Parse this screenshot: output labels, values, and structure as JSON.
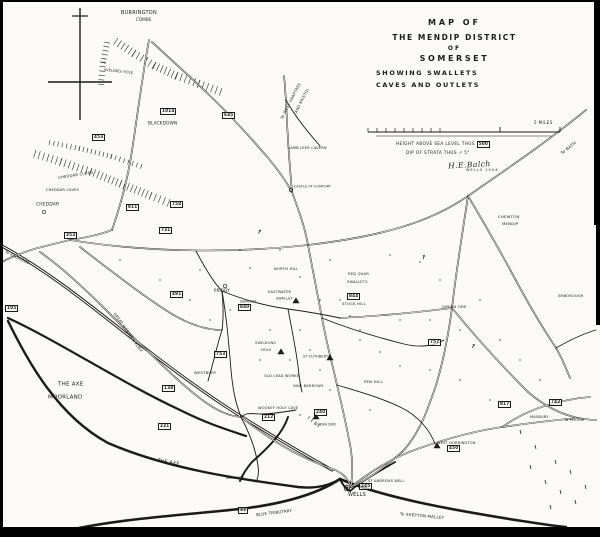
{
  "canvas": {
    "width": 600,
    "height": 537,
    "ink": "#1b1b1b",
    "paper": "#fbfaf6",
    "frame": "#000000"
  },
  "title": {
    "lines": [
      "MAP OF",
      "THE MENDIP DISTRICT",
      "OF",
      "SOMERSET",
      "SHOWING SWALLETS",
      "CAVES AND OUTLETS"
    ]
  },
  "scale_bar": {
    "right_label": "5 MILES"
  },
  "legend": {
    "height_note": "HEIGHT ABOVE SEA LEVEL THUS",
    "height_sample": "500",
    "dip_note": "DIP OF STRATA THUS",
    "dip_sample": "5°",
    "signature": "H.E.Balch",
    "place_date": "WELLS 1904"
  },
  "icons": {
    "dip_arrow": "↗",
    "north_cross": "cross"
  },
  "labels": [
    {
      "text": "BURRINGTON",
      "x": 121,
      "y": 10,
      "s": 5,
      "r": 0
    },
    {
      "text": "COMBE",
      "x": 136,
      "y": 18,
      "s": 4,
      "r": 0
    },
    {
      "text": "AVELINES HOLE",
      "x": 104,
      "y": 68,
      "s": 3.5,
      "r": 6
    },
    {
      "text": "BLACKDOWN",
      "x": 148,
      "y": 121,
      "s": 4.2,
      "r": 0
    },
    {
      "text": "CHEDDAR CLIFFS",
      "x": 58,
      "y": 176,
      "s": 3.8,
      "r": -9
    },
    {
      "text": "CHEDDAR CAVES",
      "x": 46,
      "y": 188,
      "s": 3.6,
      "r": 0
    },
    {
      "text": "CHEDDAR",
      "x": 36,
      "y": 202,
      "s": 4.4,
      "r": 0
    },
    {
      "text": "To AXBRIDGE",
      "x": 6,
      "y": 250,
      "s": 3.8,
      "r": 26
    },
    {
      "text": "GREAT WESTERN RLWY",
      "x": 116,
      "y": 312,
      "s": 3.8,
      "r": 55
    },
    {
      "text": "THE AXE",
      "x": 58,
      "y": 381,
      "s": 5.5,
      "r": 0
    },
    {
      "text": "MOORLAND",
      "x": 48,
      "y": 394,
      "s": 5.5,
      "r": 0
    },
    {
      "text": "THE AXE",
      "x": 158,
      "y": 458,
      "s": 4.8,
      "r": 9
    },
    {
      "text": "WESTBURY",
      "x": 194,
      "y": 371,
      "s": 3.8,
      "r": 0
    },
    {
      "text": "PRIDDY",
      "x": 214,
      "y": 289,
      "s": 4,
      "r": 0
    },
    {
      "text": "SWALLET",
      "x": 240,
      "y": 300,
      "s": 3.4,
      "r": 0
    },
    {
      "text": "EASTWATER",
      "x": 268,
      "y": 290,
      "s": 3.6,
      "r": 0
    },
    {
      "text": "SWALLET",
      "x": 276,
      "y": 297,
      "s": 3.4,
      "r": 0
    },
    {
      "text": "NORTH HILL",
      "x": 274,
      "y": 267,
      "s": 3.8,
      "r": 0
    },
    {
      "text": "RED QUAR",
      "x": 348,
      "y": 272,
      "s": 3.7,
      "r": 0
    },
    {
      "text": "SWALLETS",
      "x": 347,
      "y": 280,
      "s": 3.7,
      "r": 0
    },
    {
      "text": "STOCK HILL",
      "x": 342,
      "y": 302,
      "s": 3.8,
      "r": 0
    },
    {
      "text": "SWILDONS",
      "x": 255,
      "y": 341,
      "s": 3.6,
      "r": 0
    },
    {
      "text": "HOLE",
      "x": 261,
      "y": 348,
      "s": 3.6,
      "r": 0
    },
    {
      "text": "ST CUTHBERTS",
      "x": 303,
      "y": 355,
      "s": 3.4,
      "r": 0
    },
    {
      "text": "OLD LEAD WORKS",
      "x": 264,
      "y": 374,
      "s": 3.6,
      "r": 0
    },
    {
      "text": "NINE BARROWS",
      "x": 293,
      "y": 384,
      "s": 3.6,
      "r": 0
    },
    {
      "text": "PEN HILL",
      "x": 364,
      "y": 380,
      "s": 3.9,
      "r": 0
    },
    {
      "text": "WOOKEY HOLE CAVE",
      "x": 258,
      "y": 406,
      "s": 3.6,
      "r": 0
    },
    {
      "text": "HYENA DEN",
      "x": 315,
      "y": 423,
      "s": 3.3,
      "r": 0
    },
    {
      "text": "WOOKEY",
      "x": 226,
      "y": 476,
      "s": 3.8,
      "r": 0
    },
    {
      "text": "WELLS",
      "x": 348,
      "y": 492,
      "s": 5,
      "r": 0
    },
    {
      "text": "ST ANDREWS WELL",
      "x": 368,
      "y": 479,
      "s": 3.5,
      "r": 0
    },
    {
      "text": "To SHEPTON MALLET",
      "x": 400,
      "y": 512,
      "s": 4,
      "r": 5
    },
    {
      "text": "BLUE TRIBUTARY",
      "x": 256,
      "y": 513,
      "s": 4,
      "r": -7
    },
    {
      "text": "LAMB LEER CAVERN",
      "x": 288,
      "y": 146,
      "s": 3.6,
      "r": 0
    },
    {
      "text": "CASTLE OF COMFORT",
      "x": 294,
      "y": 185,
      "s": 3.2,
      "r": 0
    },
    {
      "text": "To WEST HARPTREE",
      "x": 280,
      "y": 118,
      "s": 3.8,
      "r": -63
    },
    {
      "text": "AND BRISTOL",
      "x": 294,
      "y": 112,
      "s": 3.8,
      "r": -63
    },
    {
      "text": "To BATH",
      "x": 560,
      "y": 152,
      "s": 4.2,
      "r": -38
    },
    {
      "text": "CHEWTON",
      "x": 498,
      "y": 215,
      "s": 3.9,
      "r": 0
    },
    {
      "text": "MENDIP",
      "x": 502,
      "y": 222,
      "s": 3.9,
      "r": 0
    },
    {
      "text": "EMBOROUGH",
      "x": 558,
      "y": 294,
      "s": 3.6,
      "r": 0
    },
    {
      "text": "GREEN ORE",
      "x": 442,
      "y": 305,
      "s": 3.9,
      "r": 0
    },
    {
      "text": "MASBURY",
      "x": 530,
      "y": 415,
      "s": 3.6,
      "r": 0
    },
    {
      "text": "To FROME",
      "x": 564,
      "y": 418,
      "s": 3.9,
      "r": 0
    },
    {
      "text": "WEST HORRINGTON",
      "x": 437,
      "y": 441,
      "s": 3.6,
      "r": 0
    }
  ],
  "heights": [
    {
      "value": "1014",
      "x": 160,
      "y": 108
    },
    {
      "value": "635",
      "x": 222,
      "y": 112
    },
    {
      "value": "453",
      "x": 92,
      "y": 134
    },
    {
      "value": "811",
      "x": 126,
      "y": 204
    },
    {
      "value": "758",
      "x": 170,
      "y": 201
    },
    {
      "value": "731",
      "x": 159,
      "y": 227
    },
    {
      "value": "353",
      "x": 64,
      "y": 232
    },
    {
      "value": "105",
      "x": 5,
      "y": 305
    },
    {
      "value": "138",
      "x": 162,
      "y": 385
    },
    {
      "value": "231",
      "x": 158,
      "y": 423
    },
    {
      "value": "753",
      "x": 214,
      "y": 351
    },
    {
      "value": "491",
      "x": 170,
      "y": 291
    },
    {
      "value": "840",
      "x": 238,
      "y": 304
    },
    {
      "value": "844",
      "x": 347,
      "y": 293
    },
    {
      "value": "212",
      "x": 262,
      "y": 414
    },
    {
      "value": "240",
      "x": 314,
      "y": 409
    },
    {
      "value": "245",
      "x": 359,
      "y": 483
    },
    {
      "value": "450",
      "x": 447,
      "y": 445
    },
    {
      "value": "817",
      "x": 498,
      "y": 401
    },
    {
      "value": "742",
      "x": 549,
      "y": 399
    },
    {
      "value": "757",
      "x": 428,
      "y": 339
    },
    {
      "value": "33",
      "x": 238,
      "y": 507
    }
  ],
  "dip_arrows": [
    {
      "x": 256,
      "y": 230,
      "rot": -20
    },
    {
      "x": 420,
      "y": 256,
      "rot": -30
    },
    {
      "x": 470,
      "y": 344,
      "rot": -15
    }
  ]
}
